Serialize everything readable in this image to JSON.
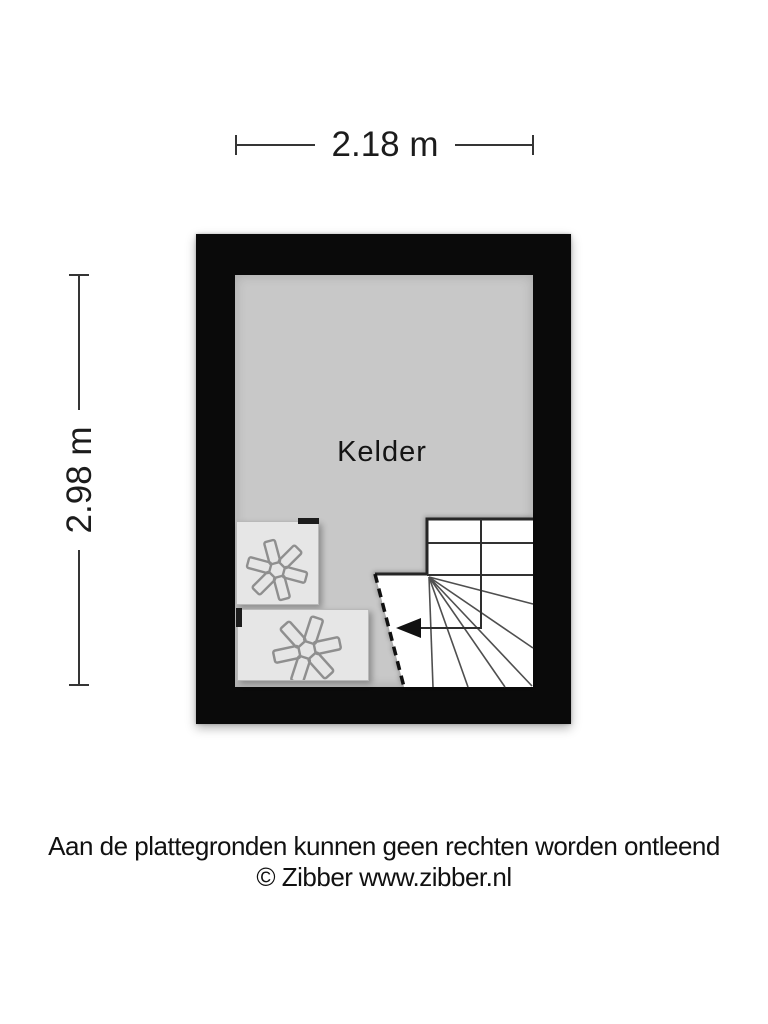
{
  "dimensions": {
    "top": {
      "label": "2.18 m"
    },
    "left": {
      "label": "2.98 m"
    }
  },
  "plan": {
    "room_label": "Kelder",
    "fixtures": {
      "appliance_icon": "asterisk",
      "stair_direction_icon": "arrow-left"
    }
  },
  "footer": {
    "disclaimer": "Aan de plattegronden kunnen geen rechten worden ontleend",
    "copyright": "© Zibber www.zibber.nl"
  },
  "colors": {
    "wall": "#0a0a0a",
    "floor": "#c8c8c8",
    "appliance_fill": "#e6e6e6",
    "stair_fill": "#ffffff",
    "stair_stroke": "#2b2b2b",
    "dimension_line": "#353535",
    "text": "#1a1a1a"
  }
}
